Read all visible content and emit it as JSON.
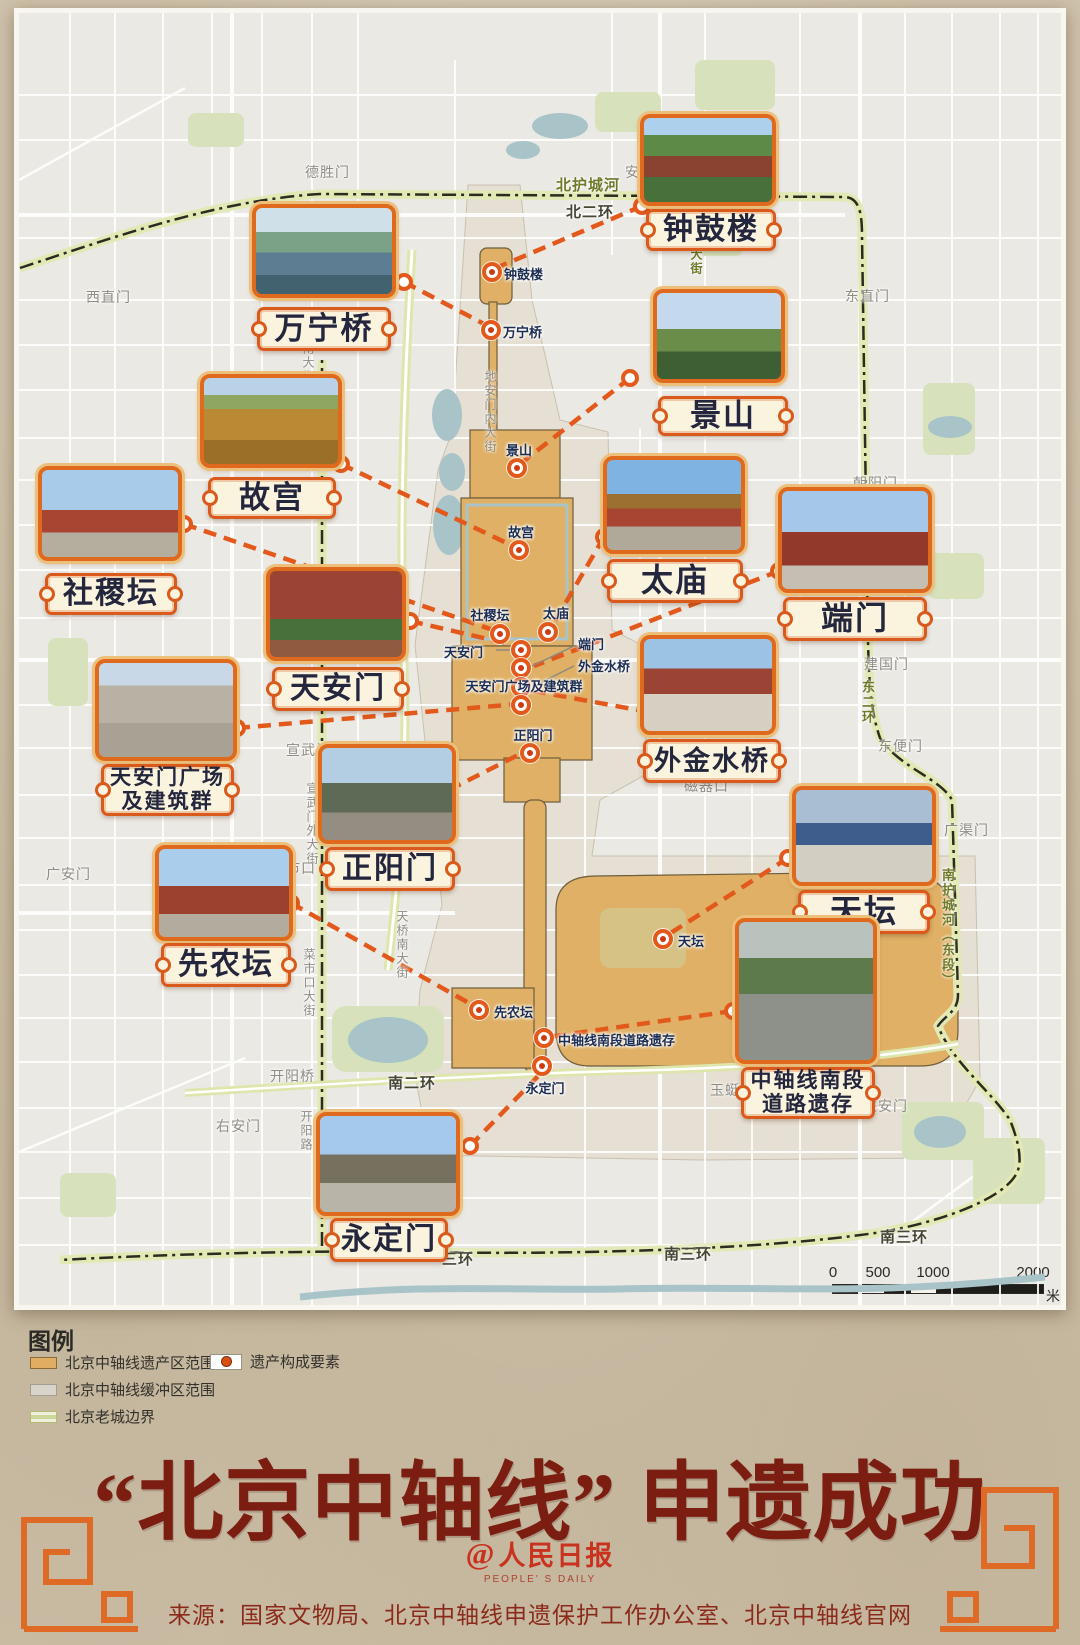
{
  "title": "“北京中轴线” 申遗成功",
  "logo": {
    "at": "@",
    "cn": "人民日报",
    "en": "PEOPLE' S DAILY"
  },
  "source": "来源：国家文物局、北京中轴线申遗保护工作办公室、北京中轴线官网",
  "legend": {
    "heading": "图例",
    "items": [
      {
        "label": "北京中轴线遗产区范围"
      },
      {
        "label": "北京中轴线缓冲区范围"
      },
      {
        "label": "北京老城边界"
      },
      {
        "label": "遗产构成要素"
      }
    ]
  },
  "scale_bar": {
    "ticks": [
      "0",
      "500",
      "1000",
      "2000"
    ],
    "unit": "米"
  },
  "sites": [
    {
      "id": "zhonggulou",
      "name": "钟鼓楼",
      "card_label": "钟鼓楼"
    },
    {
      "id": "wanningqiao",
      "name": "万宁桥",
      "card_label": "万宁桥"
    },
    {
      "id": "jingshan",
      "name": "景山",
      "card_label": "景山"
    },
    {
      "id": "gugong",
      "name": "故宫",
      "card_label": "故宫"
    },
    {
      "id": "shejitan",
      "name": "社稷坛",
      "card_label": "社稷坛"
    },
    {
      "id": "taimiao",
      "name": "太庙",
      "card_label": "太庙"
    },
    {
      "id": "duanmen",
      "name": "端门",
      "card_label": "端门"
    },
    {
      "id": "tiananmen",
      "name": "天安门",
      "card_label": "天安门"
    },
    {
      "id": "waijinshuiqiao",
      "name": "外金水桥",
      "card_label": "外金水桥"
    },
    {
      "id": "guangchang",
      "name": "天安门广场及建筑群",
      "card_label": "天安门广场\n及建筑群"
    },
    {
      "id": "zhengyangmen",
      "name": "正阳门",
      "card_label": "正阳门"
    },
    {
      "id": "tiantan",
      "name": "天坛",
      "card_label": "天坛"
    },
    {
      "id": "xiannongtan",
      "name": "先农坛",
      "card_label": "先农坛"
    },
    {
      "id": "daoluyicun",
      "name": "中轴线南段道路遗存",
      "card_label": "中轴线南段\n道路遗存"
    },
    {
      "id": "yongdingmen",
      "name": "永定门",
      "card_label": "永定门"
    }
  ],
  "map": {
    "streets": [
      {
        "text": "德胜门"
      },
      {
        "text": "安定门"
      },
      {
        "text": "北护城河"
      },
      {
        "text": "北二环"
      },
      {
        "text": "西直门"
      },
      {
        "text": "东直门"
      },
      {
        "text": "朝阳门"
      },
      {
        "text": "建国门"
      },
      {
        "text": "东便门"
      },
      {
        "text": "广渠门"
      },
      {
        "text": "东二环"
      },
      {
        "text": "南护城河（东段）"
      },
      {
        "text": "宣武门"
      },
      {
        "text": "宣武门外大街"
      },
      {
        "text": "市口"
      },
      {
        "text": "广安门"
      },
      {
        "text": "菜市口大街"
      },
      {
        "text": "磁器口"
      },
      {
        "text": "天桥南大街"
      },
      {
        "text": "右安门"
      },
      {
        "text": "开阳桥"
      },
      {
        "text": "开阳路"
      },
      {
        "text": "南二环"
      },
      {
        "text": "左安门"
      },
      {
        "text": "玉蜓桥"
      },
      {
        "text": "南三环"
      },
      {
        "text": "南三环"
      },
      {
        "text": "三环"
      },
      {
        "text": "地安门内大街"
      },
      {
        "text": "南大街"
      },
      {
        "text": "大街"
      }
    ]
  },
  "colors": {
    "accent_orange": "#e2591b",
    "heritage_zone": "#dfb065",
    "buffer_zone": "#e6dfd3",
    "old_city_boundary": "#cdd79c",
    "title_red": "#7b1d10",
    "logo_red": "#c8321f",
    "plaque_cream": "#faf3dd"
  }
}
